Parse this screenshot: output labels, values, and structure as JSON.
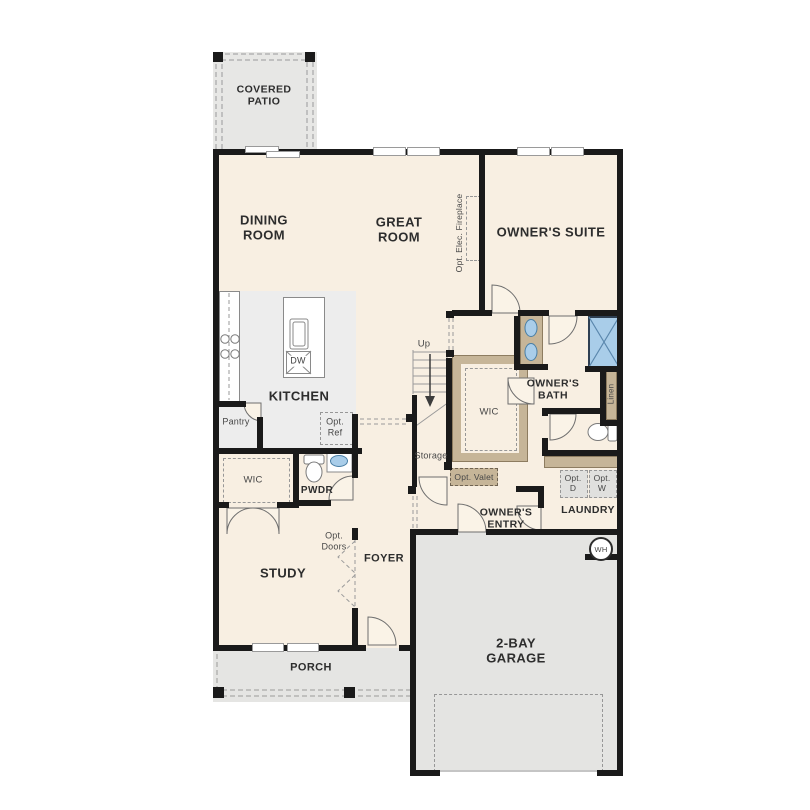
{
  "plan": {
    "rooms": {
      "covered_patio": "COVERED PATIO",
      "dining_room": "DINING ROOM",
      "great_room": "GREAT ROOM",
      "owners_suite": "OWNER'S SUITE",
      "kitchen": "KITCHEN",
      "pantry": "Pantry",
      "owners_bath": "OWNER'S BATH",
      "wic_owners": "WIC",
      "wic_study": "WIC",
      "pwdr": "PWDR",
      "study": "STUDY",
      "foyer": "FOYER",
      "owners_entry": "OWNER'S ENTRY",
      "laundry": "LAUNDRY",
      "storage": "Storage",
      "linen": "Linen",
      "porch": "PORCH",
      "garage": "2-BAY GARAGE"
    },
    "annotations": {
      "opt_elec_fireplace": "Opt. Elec. Fireplace",
      "opt_ref": "Opt. Ref",
      "opt_valet": "Opt. Valet",
      "opt_doors": "Opt. Doors",
      "opt_dryer": "Opt. D",
      "opt_washer": "Opt. W",
      "up": "Up",
      "dishwasher": "DW",
      "water_heater": "WH"
    },
    "colors": {
      "wall": "#1a1a1a",
      "interior_fill": "#f8efe2",
      "kitchen_fill": "#ededed",
      "outdoor_fill": "#e7e7e5",
      "garage_fill": "#e4e4e2",
      "cabinet_tan": "#c6b598",
      "fixture_blue": "#a9cde9"
    }
  }
}
